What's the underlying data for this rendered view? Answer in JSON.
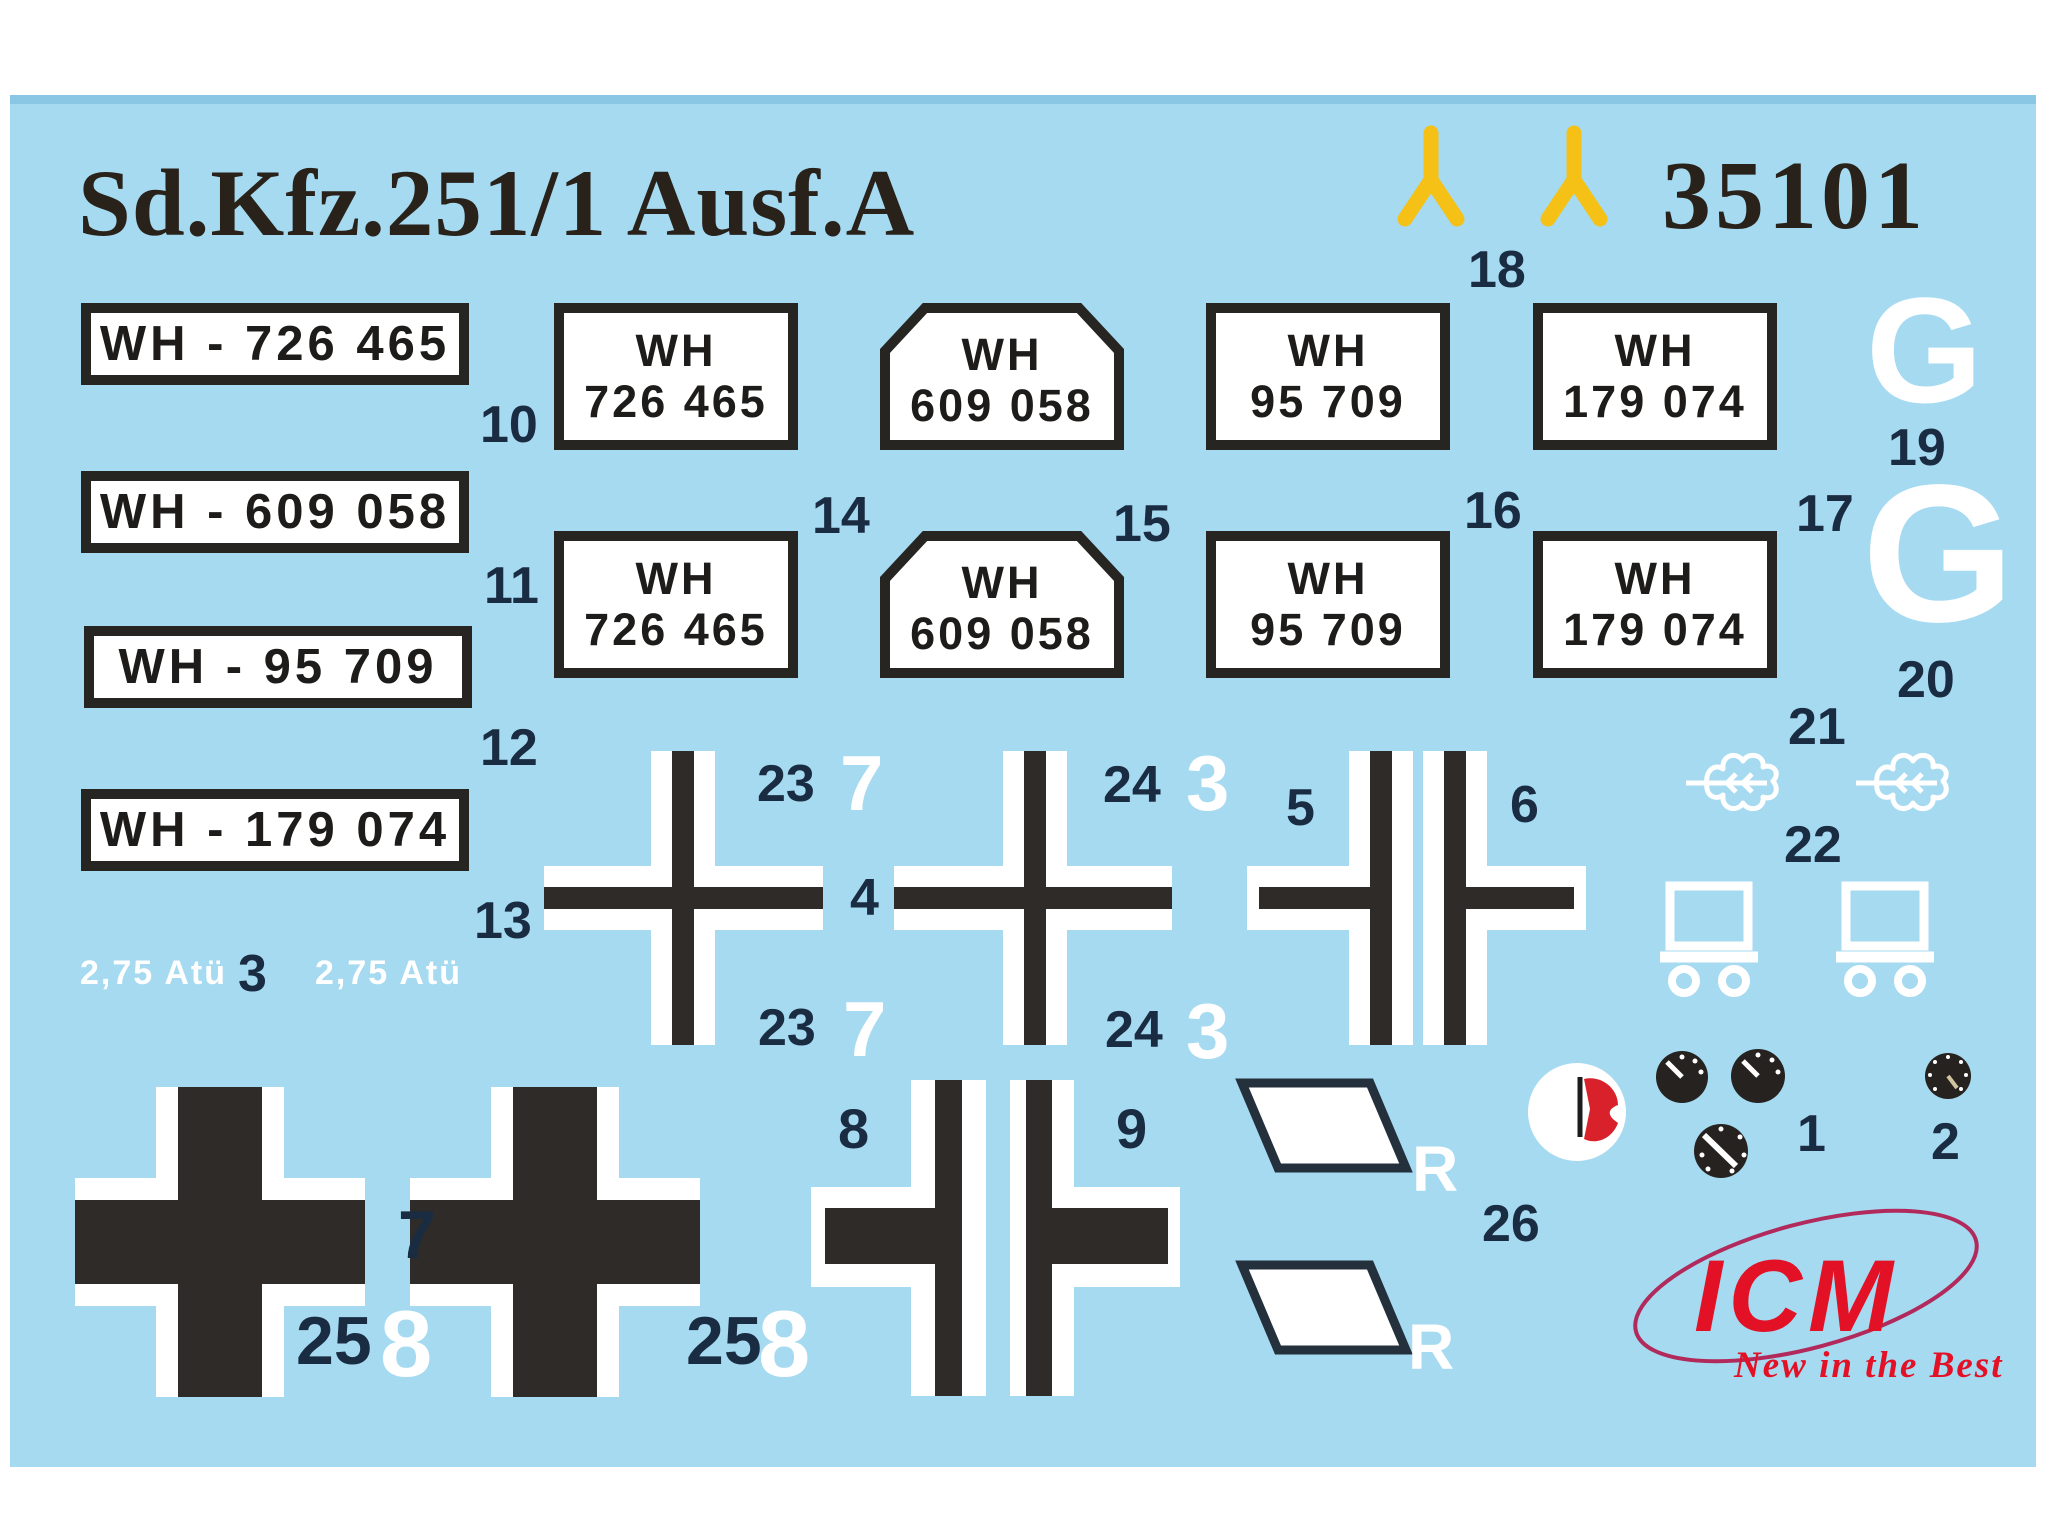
{
  "title": "Sd.Kfz.251/1 Ausf.A",
  "kit_number": "35101",
  "colors": {
    "sheet_blue": "#a5daf1",
    "decal_black": "#2e2b29",
    "label_dark_navy": "#1a2c42",
    "antenna_yellow": "#f5c117",
    "logo_red": "#e31126",
    "swoosh_magenta": "#b12a5b",
    "decal_white": "#ffffff"
  },
  "antenna": {
    "num": "18"
  },
  "registration_bars": [
    {
      "text": "WH - 726 465",
      "num": "10"
    },
    {
      "text": "WH - 609 058",
      "num": "11"
    },
    {
      "text": "WH - 95 709",
      "num": "12"
    },
    {
      "text": "WH - 179 074",
      "num": "13"
    }
  ],
  "pressure": {
    "left": "2,75 Atü",
    "mid": "3",
    "right": "2,75 Atü"
  },
  "plate_grid": {
    "cols": [
      {
        "line1": "WH",
        "line2": "726 465",
        "shape": "rectangle",
        "num": "14"
      },
      {
        "line1": "WH",
        "line2": "609 058",
        "shape": "pentagon",
        "num": "15"
      },
      {
        "line1": "WH",
        "line2": "95 709",
        "shape": "rectangle",
        "num": "16"
      },
      {
        "line1": "WH",
        "line2": "179 074",
        "shape": "rectangle",
        "num": "17"
      }
    ]
  },
  "g_decals": [
    {
      "letter": "G",
      "num": "19"
    },
    {
      "letter": "G",
      "num": "20"
    }
  ],
  "oak_leaves": {
    "num_left": "21",
    "num": "22"
  },
  "crosses": {
    "thin_1": {
      "top_left": "23",
      "top_right": "7",
      "mid": "4",
      "bottom_left": "23",
      "bottom_right": "7"
    },
    "thin_2": {
      "top_left": "24",
      "top_right": "3",
      "bottom_left": "24",
      "bottom_right": "3"
    },
    "half_left_num": "5",
    "half_right_num": "6",
    "big_num": "7",
    "big_left_bottom": {
      "left": "25",
      "right": "8"
    },
    "big_right_bottom": {
      "left": "25",
      "right": "8"
    },
    "split_left_num": "8",
    "split_right_num": "9"
  },
  "rhombus": {
    "r1": "R",
    "r2": "R",
    "num": "26"
  },
  "gauges": {
    "num1": "1",
    "num2": "2"
  },
  "logo": {
    "name": "ICM",
    "tagline": "New in the Best"
  }
}
